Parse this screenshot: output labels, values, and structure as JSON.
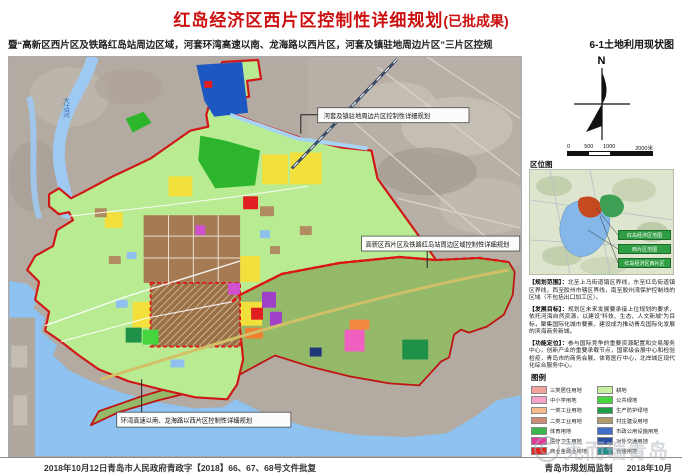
{
  "header": {
    "title": "红岛经济区西片区控制性详细规划",
    "title_suffix": "(已批成果)",
    "subtitle": "暨“高新区西片区及铁路红岛站周边区域，河套环湾高速以南、龙海路以西片区，河套及镇驻地周边片区”三片区控规",
    "sheet_label": "6-1土地利用现状图"
  },
  "map": {
    "river_label": "大沽河",
    "callouts": [
      "河套及镇驻地周边片区控制性详细规划",
      "高新区西片区及铁路红岛站周边区域控制性详细规划",
      "环湾高速以南、龙海路以西片区控制性详细规划"
    ]
  },
  "sidebar": {
    "north_label": "N",
    "scale_ticks": [
      "0",
      "500",
      "1000",
      "2000米"
    ],
    "location_map": {
      "title": "区位图",
      "labels": [
        "红岛经济区范围",
        "西片区范围",
        "红岛经济区西片区"
      ]
    },
    "notes": [
      {
        "label": "【规划范围】：",
        "text": "北至上马街道镇区界线，东至红岛街道镇区界线，西至胶州市辖区界线，南至胶州湾保护控制线的区域（不包括出口加工区）。"
      },
      {
        "label": "【发展目标】：",
        "text": "规划区未来发展要承接上位规划的要求，依托河海自然资源，以建设“科技、生态、人文新城”为目标，聚集国际化城市要素，建设成为推动青岛国际化发展的滨海商务新城。"
      },
      {
        "label": "【功能定位】：",
        "text": "参与国际竞争的重要资源配置和交易服务中心，创新产业的重要承载节点，国家级会展中心和检验检疫，青岛市的商务会展、体育医疗中心，北岸城区现代化综合服务中心。"
      }
    ],
    "legend": {
      "title": "图例",
      "left": [
        {
          "color": "#F2A39B",
          "label": "三类居住用地"
        },
        {
          "color": "#F5A3CB",
          "label": "中小学用地"
        },
        {
          "color": "#F6BC8E",
          "label": "一类工业用地"
        },
        {
          "color": "#D08D76",
          "label": "二类工业用地"
        },
        {
          "color": "#3CB54A",
          "label": "体育用地"
        },
        {
          "color": "#E2399B",
          "label": "医疗卫生用地"
        },
        {
          "color": "#E32222",
          "label": "商业金融业用地"
        },
        {
          "color": "#FBF442",
          "label": "二类居住用地"
        },
        {
          "color": "#F5F5F0",
          "label": "道路广场用地"
        }
      ],
      "right": [
        {
          "color": "#C7EF9E",
          "label": "耕地"
        },
        {
          "color": "#46D53E",
          "label": "公共绿地"
        },
        {
          "color": "#1E9E46",
          "label": "生产防护绿地"
        },
        {
          "color": "#B39A6A",
          "label": "村庄建设用地"
        },
        {
          "color": "#3F6FC8",
          "label": "市政公用设施用地"
        },
        {
          "color": "#2A4FA0",
          "label": "对外交通用地"
        },
        {
          "color": "#1F8C8C",
          "label": "仓储用地"
        },
        {
          "color": "#3E86D8",
          "label": "水域"
        },
        {
          "color": "#7B2FA6",
          "label": "特殊用地"
        }
      ]
    }
  },
  "footer": {
    "left": "2018年10月12日青岛市人民政府青政字【2018】66、67、68号文件批复",
    "maker": "青岛市规划局监制",
    "date": "2018年10月"
  },
  "watermark": {
    "text": "克而瑞青岛"
  }
}
